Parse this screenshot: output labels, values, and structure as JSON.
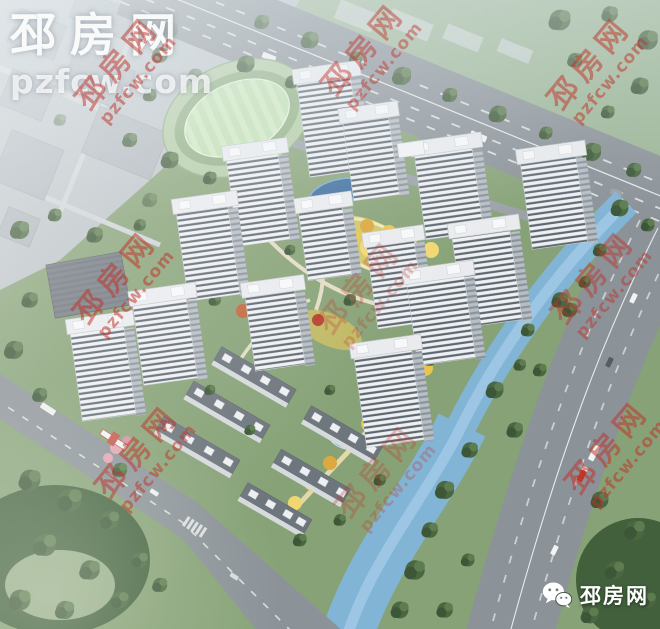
{
  "logo": {
    "text_cn": "邳房网",
    "text_url": "pzfcw.com",
    "color": "#ffffff"
  },
  "watermark": {
    "text_cn": "邳房网",
    "text_url": "pzfcw.com",
    "color": "#c03227"
  },
  "badge": {
    "label": "邳房网",
    "icon": "wechat-icon"
  },
  "scene": {
    "subject": "aerial rendering of a residential development with high-rise towers, low-rise rows, central garden, sports field, river and highways",
    "palette": {
      "grass": "#87a277",
      "dark_trees": "#4b6741",
      "road": "#8b9298",
      "river": "#82b4d6",
      "tower_facade": "#eef0f2",
      "window_stripe": "#5d6771",
      "garden_yellow": "#e9c54d",
      "sports_field": "#c0dfb1",
      "urban_haze": "#bcc3c7",
      "pond": "#3f6f9e"
    }
  }
}
